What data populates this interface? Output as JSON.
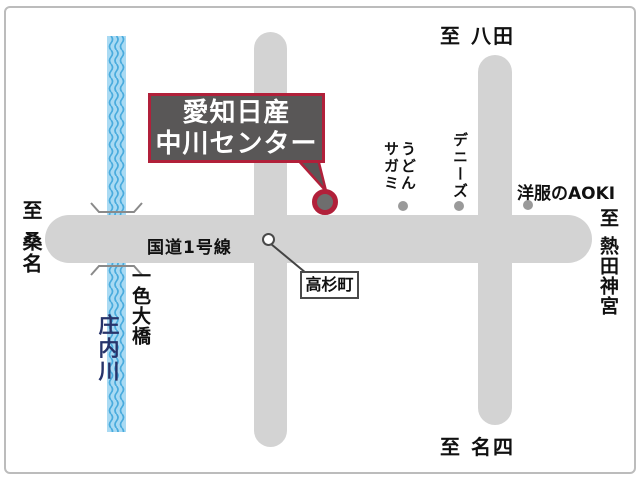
{
  "theme": {
    "road": "#d3d3d3",
    "river_fill": "#a9daf3",
    "river_wave": "#49abdd",
    "callout_bg": "#595757",
    "accent_red": "#b1203a",
    "navy": "#27346b",
    "dot": "#9a9a9a"
  },
  "map": {
    "callout": {
      "lines": [
        "愛知日産",
        "中川センター"
      ]
    },
    "route_label": "国道1号線",
    "directions": {
      "west": "至 桑名",
      "north": "至 八田",
      "east": "至 熱田神宮",
      "south": "至 名四"
    },
    "intersection_label": "高杉町",
    "river_name": "庄内川",
    "bridge_name": "一色大橋",
    "landmarks": [
      {
        "lines": [
          "うどん",
          "サガミ"
        ]
      },
      {
        "lines": [
          "デニーズ"
        ]
      },
      {
        "lines": [
          "洋服のAOKI"
        ]
      }
    ]
  }
}
